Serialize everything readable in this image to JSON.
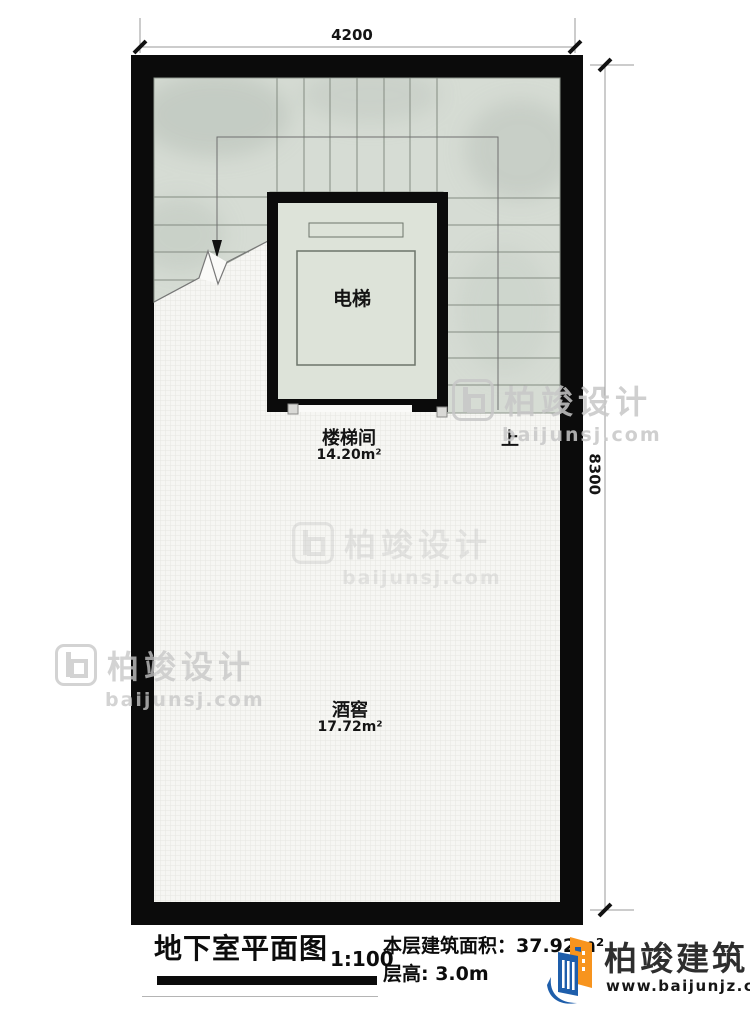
{
  "dimensions": {
    "top": "4200",
    "right": "8300"
  },
  "rooms": {
    "elevator": {
      "label": "电梯"
    },
    "stairwell": {
      "label": "楼梯间",
      "area": "14.20m²"
    },
    "wine_cellar": {
      "label": "酒窖",
      "area": "17.72m²"
    }
  },
  "stairs": {
    "direction_label": "上"
  },
  "title_block": {
    "title": "地下室平面图",
    "scale": "1:100",
    "floor_area": "本层建筑面积：37.92m²",
    "floor_height": "层高: 3.0m"
  },
  "branding": {
    "company": "柏竣建筑",
    "website": "www.baijunjz.com"
  },
  "watermark": {
    "name": "柏竣设计",
    "site": "baijunsj.com"
  },
  "colors": {
    "wall": "#0b0b0b",
    "stair_area": "#d6dcd4",
    "elevator_interior": "#dde3d9",
    "floor": "#f6f6f3",
    "brand_blue": "#1e5eab",
    "brand_orange": "#f7941e"
  }
}
